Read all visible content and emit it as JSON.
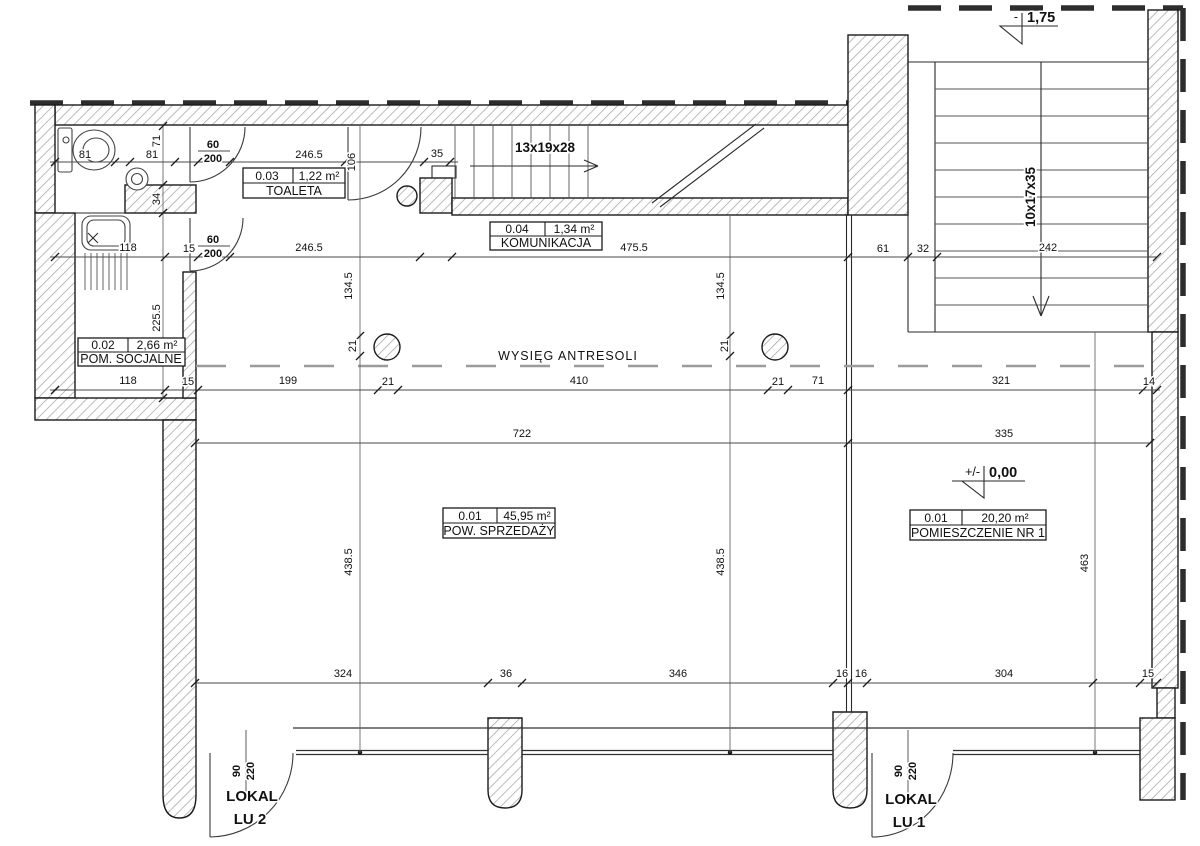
{
  "rooms": [
    {
      "number": "0.03",
      "area": "1,22 m²",
      "name": "TOALETA"
    },
    {
      "number": "0.04",
      "area": "1,34 m²",
      "name": "KOMUNIKACJA"
    },
    {
      "number": "0.02",
      "area": "2,66 m²",
      "name": "POM. SOCJALNE"
    },
    {
      "number": "0.01",
      "area": "45,95 m²",
      "name": "POW. SPRZEDAŻY"
    },
    {
      "number": "0.01",
      "area": "20,20 m²",
      "name": "POMIESZCZENIE NR 1"
    }
  ],
  "stairs": {
    "corridor_flight": "13x19x28",
    "main_flight": "10x17x35"
  },
  "levels": {
    "upper": {
      "prefix": "-",
      "value": "1,75"
    },
    "ground": {
      "prefix": "+/-",
      "value": "0,00"
    }
  },
  "annotations": {
    "mezzanine": "WYSIĘG ANTRESOLI"
  },
  "units": [
    {
      "name": "LOKAL",
      "number": "LU 2"
    },
    {
      "name": "LOKAL",
      "number": "LU 1"
    }
  ],
  "door_pairs": [
    {
      "w": "60",
      "h": "200"
    },
    {
      "w": "60",
      "h": "200"
    },
    {
      "w": "90",
      "h": "220"
    },
    {
      "w": "90",
      "h": "220"
    }
  ],
  "dims": {
    "h_top": [
      "81",
      "81",
      "246.5",
      "35"
    ],
    "h_upper": [
      "118",
      "15",
      "246.5",
      "475.5",
      "61",
      "32",
      "242"
    ],
    "h_mezz": [
      "118",
      "15",
      "199",
      "21",
      "410",
      "21",
      "71",
      "321",
      "14"
    ],
    "h_mid": [
      "722",
      "335"
    ],
    "h_bottom": [
      "324",
      "36",
      "346",
      "16",
      "16",
      "304",
      "15"
    ],
    "v_left": [
      "71",
      "34",
      "225.5"
    ],
    "v_misc": [
      "106"
    ],
    "v_cols": [
      "134.5",
      "21",
      "134.5",
      "21"
    ],
    "v_rooms": [
      "438.5",
      "438.5",
      "463"
    ]
  }
}
